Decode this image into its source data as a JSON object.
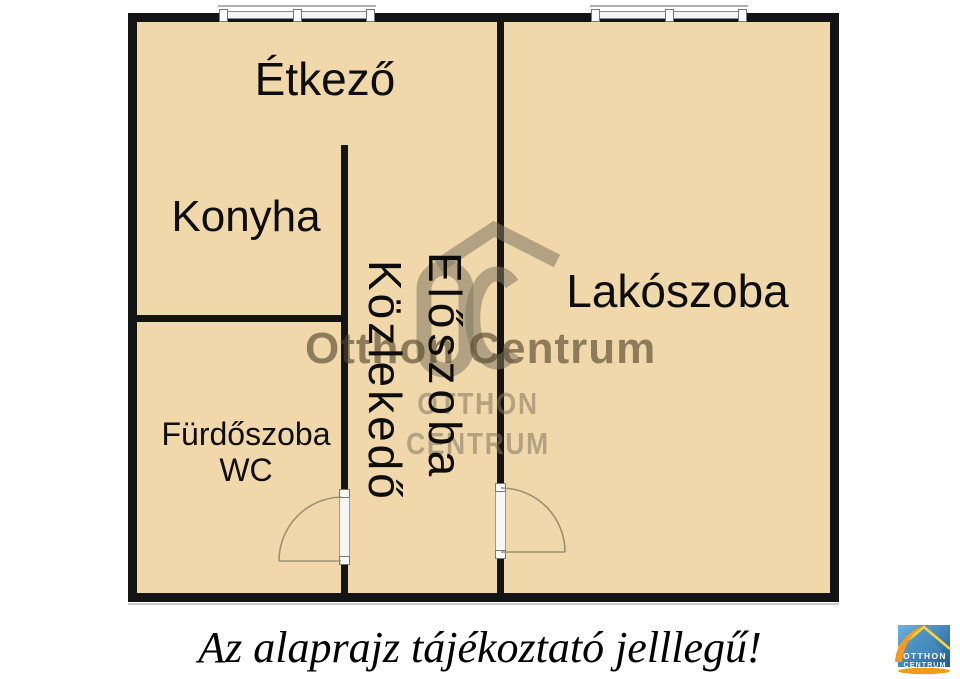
{
  "colors": {
    "floor": "#f0d8aa",
    "wall": "#141414",
    "watermark": "#8f8166",
    "logo_blue": "#2b6ca3",
    "logo_blue_light": "#6db3e0",
    "logo_orange": "#f49a1c",
    "logo_yellow": "#ffd23b"
  },
  "rooms": {
    "etkezo": {
      "label": "Étkező"
    },
    "konyha": {
      "label": "Konyha"
    },
    "lakoszoba": {
      "label": "Lakószoba"
    },
    "furdoszoba": {
      "label": "Fürdőszoba",
      "label2": "WC"
    },
    "eloszoba": {
      "label": "Előszoba"
    },
    "kozlekedo": {
      "label": "Közlekedő"
    }
  },
  "watermark": {
    "text": "Otthon Centrum",
    "line1": "OTTHON",
    "line2": "CENTRUM"
  },
  "caption": "Az alaprajz tájékoztató jelllegű!",
  "logo": {
    "line1": "OTTHON",
    "line2": "CENTRUM"
  }
}
